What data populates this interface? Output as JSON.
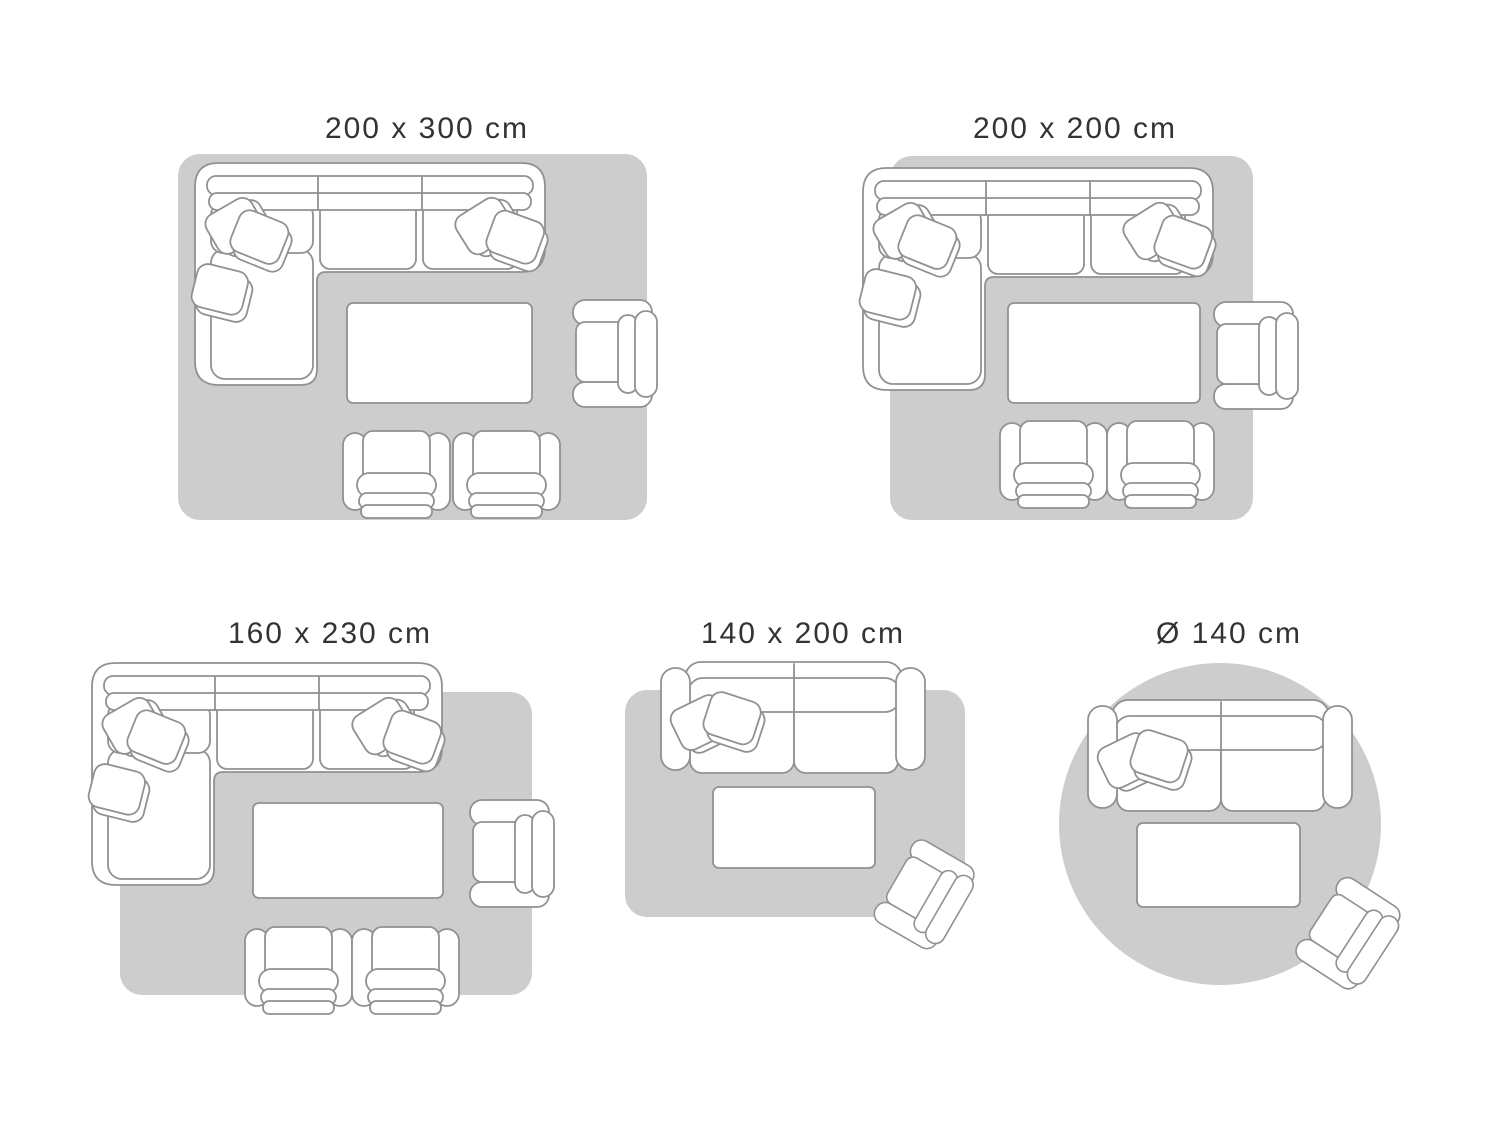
{
  "colors": {
    "rug": "#cdcdcd",
    "outline": "#919191",
    "furniture_fill": "#ffffff",
    "label_text": "#333333",
    "page_bg": "#ffffff"
  },
  "panels": [
    {
      "label": "200 x 300 cm",
      "rug_shape": "rectangle",
      "furniture": [
        "corner-sofa-with-cushions",
        "coffee-table",
        "armchair",
        "club-chair",
        "club-chair"
      ]
    },
    {
      "label": "200 x 200 cm",
      "rug_shape": "square",
      "furniture": [
        "corner-sofa-with-cushions",
        "coffee-table",
        "armchair",
        "club-chair",
        "club-chair"
      ]
    },
    {
      "label": "160 x 230 cm",
      "rug_shape": "rectangle",
      "furniture": [
        "corner-sofa-with-cushions",
        "coffee-table",
        "armchair",
        "club-chair",
        "club-chair"
      ]
    },
    {
      "label": "140 x 200 cm",
      "rug_shape": "rectangle",
      "furniture": [
        "two-seat-sofa-with-cushions",
        "coffee-table",
        "angled-armchair"
      ]
    },
    {
      "label": "Ø 140 cm",
      "rug_shape": "circle",
      "furniture": [
        "two-seat-sofa-with-cushions",
        "coffee-table",
        "angled-armchair"
      ]
    }
  ]
}
